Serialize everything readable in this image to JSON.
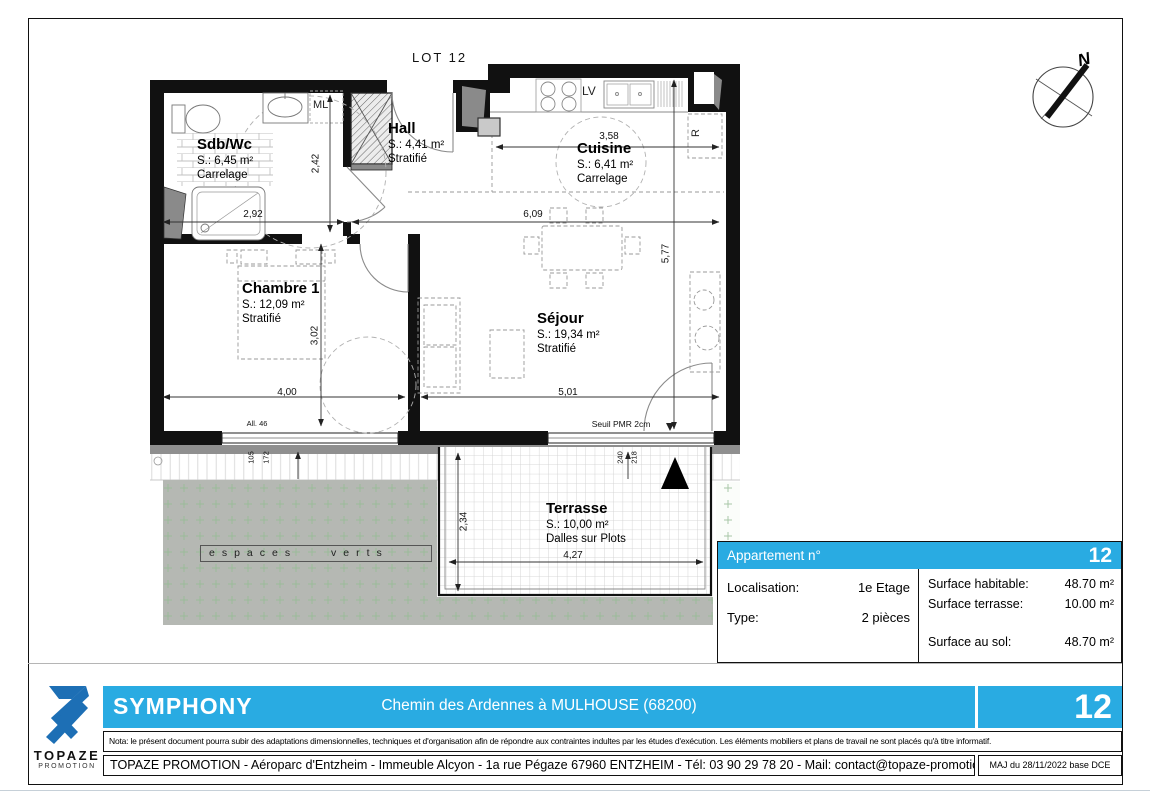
{
  "colors": {
    "accent": "#29abe2",
    "wall": "#111111",
    "green_area": "#b5b8b3",
    "logo_blue": "#1d6fb5"
  },
  "plan": {
    "lot_label": "LOT 12",
    "north_label": "N",
    "rooms": {
      "sdb": {
        "name": "Sdb/Wc",
        "surface": "S.: 6,45 m²",
        "floor": "Carrelage"
      },
      "hall": {
        "name": "Hall",
        "surface": "S.: 4,41 m²",
        "floor": "Stratifié"
      },
      "cuisine": {
        "name": "Cuisine",
        "surface": "S.: 6,41 m²",
        "floor": "Carrelage"
      },
      "chambre": {
        "name": "Chambre 1",
        "surface": "S.: 12,09 m²",
        "floor": "Stratifié"
      },
      "sejour": {
        "name": "Séjour",
        "surface": "S.: 19,34 m²",
        "floor": "Stratifié"
      },
      "terrasse": {
        "name": "Terrasse",
        "surface": "S.: 10,00 m²",
        "floor": "Dalles sur Plots"
      }
    },
    "appliances": {
      "washing_machine": "ML",
      "dishwasher": "LV",
      "fridge": "R"
    },
    "dims": {
      "sdb_width": "2,92",
      "sdb_height": "2,42",
      "kitchen_sejour_width": "6,09",
      "kitchen_width": "3,58",
      "kitchen_sejour_height": "5,77",
      "chambre_height": "3,02",
      "chambre_width": "4,00",
      "sejour_width": "5,01",
      "terrasse_height": "2,34",
      "terrasse_width": "4,27",
      "window_sill": "All. 46",
      "window_h1": "105",
      "window_h2": "172",
      "bay_h1": "240",
      "bay_h2": "218",
      "seuil": "Seuil PMR 2cm"
    },
    "green_label": "espaces verts"
  },
  "info_table": {
    "header": "Appartement n°",
    "apartment_number": "12",
    "left_rows": [
      {
        "label": "Localisation:",
        "value": "1e Etage"
      },
      {
        "label": "Type:",
        "value": "2 pièces"
      }
    ],
    "right_rows": [
      {
        "label": "Surface habitable:",
        "value": "48.70 m²"
      },
      {
        "label": "Surface terrasse:",
        "value": "10.00 m²"
      },
      {
        "label": "Surface au sol:",
        "value": "48.70 m²"
      }
    ]
  },
  "footer": {
    "logo_title": "TOPAZE",
    "logo_subtitle": "PROMOTION",
    "program_name": "SYMPHONY",
    "program_address": "Chemin des Ardennes à MULHOUSE (68200)",
    "lot_number": "12",
    "nota": "Nota: le présent document pourra subir des adaptations dimensionnelles, techniques et d'organisation afin de répondre aux contraintes indultes par les études d'exécution. Les éléments mobiliers et plans de travail ne sont placés qu'à titre informatif.",
    "company_line": "TOPAZE PROMOTION - Aéroparc d'Entzheim - Immeuble Alcyon - 1a rue Pégaze 67960 ENTZHEIM - Tél: 03 90 29 78 20 - Mail: contact@topaze-promotion.com",
    "revision": "MAJ du 28/11/2022 base DCE"
  }
}
